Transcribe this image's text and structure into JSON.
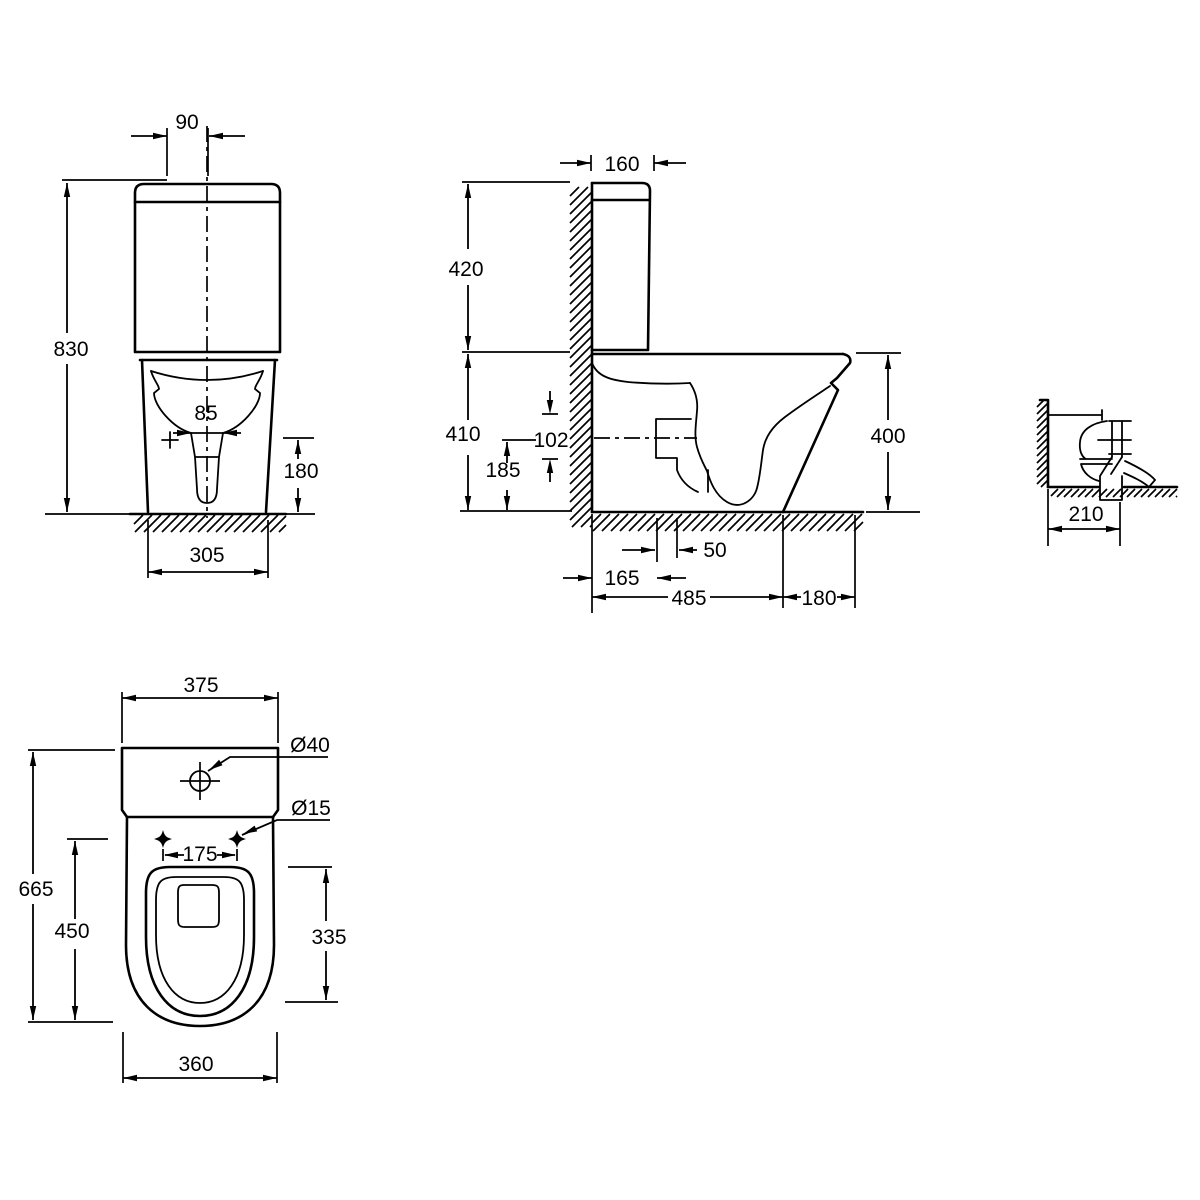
{
  "drawing": {
    "background": "#ffffff",
    "line_color": "#000000",
    "views": {
      "front": {
        "dims": {
          "flush_button_offset": "90",
          "overall_height": "830",
          "outlet_width": "85",
          "trap_height": "180",
          "base_width": "305"
        }
      },
      "side": {
        "dims": {
          "cistern_depth": "160",
          "cistern_height": "420",
          "bowl_height": "410",
          "outlet_bore": "102",
          "outlet_centre_height": "185",
          "rim_height": "400",
          "soil_offset": "165",
          "soil_setback": "50",
          "overall_depth": "485",
          "front_clearance": "180"
        }
      },
      "outlet_detail": {
        "dims": {
          "wall_to_outlet": "210"
        }
      },
      "plan": {
        "dims": {
          "cistern_width": "375",
          "lid_hole_dia": "Ø40",
          "fixing_hole_dia": "Ø15",
          "fixing_centres": "175",
          "overall_length": "665",
          "fixing_to_front": "450",
          "seat_length": "335",
          "bowl_width": "360"
        }
      }
    }
  }
}
